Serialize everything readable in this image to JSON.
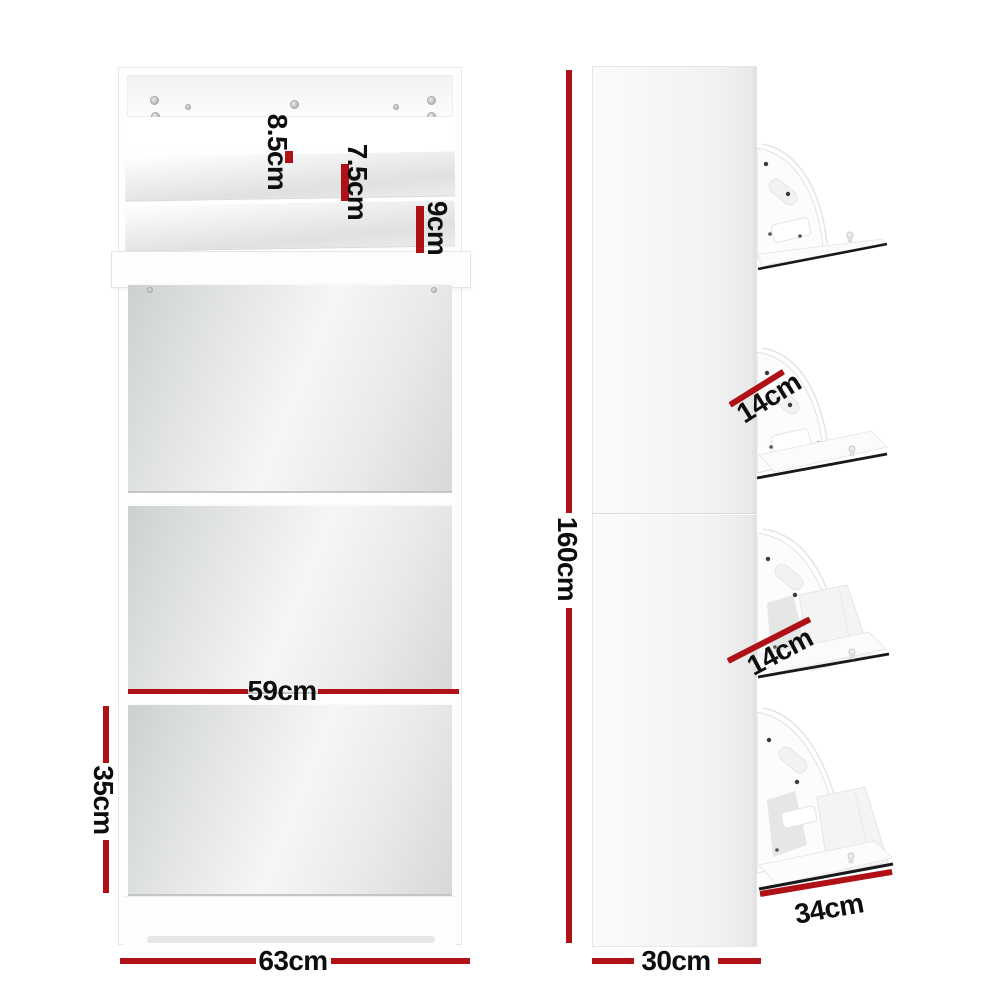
{
  "colors": {
    "dimension_red": "#b01116",
    "label_text": "#0e0e0e",
    "shelf_edge_black": "#191919",
    "mirror_tint": "#d6d8d9",
    "cabinet_white": "#fdfdfd"
  },
  "front_view": {
    "labels": [
      {
        "id": "top-shelf-depth",
        "value": "8.5cm"
      },
      {
        "id": "second-shelf-depth",
        "value": "7.5cm"
      },
      {
        "id": "third-shelf-depth",
        "value": "9cm"
      },
      {
        "id": "mirror-width",
        "value": "59cm"
      },
      {
        "id": "lower-door-height",
        "value": "35cm"
      },
      {
        "id": "overall-width",
        "value": "63cm"
      }
    ]
  },
  "side_view": {
    "labels": [
      {
        "id": "overall-height",
        "value": "160cm"
      },
      {
        "id": "upper-tray-depth",
        "value": "14cm"
      },
      {
        "id": "lower-tray-depth",
        "value": "14cm"
      },
      {
        "id": "open-door-length",
        "value": "34cm"
      },
      {
        "id": "overall-depth",
        "value": "30cm"
      }
    ]
  }
}
